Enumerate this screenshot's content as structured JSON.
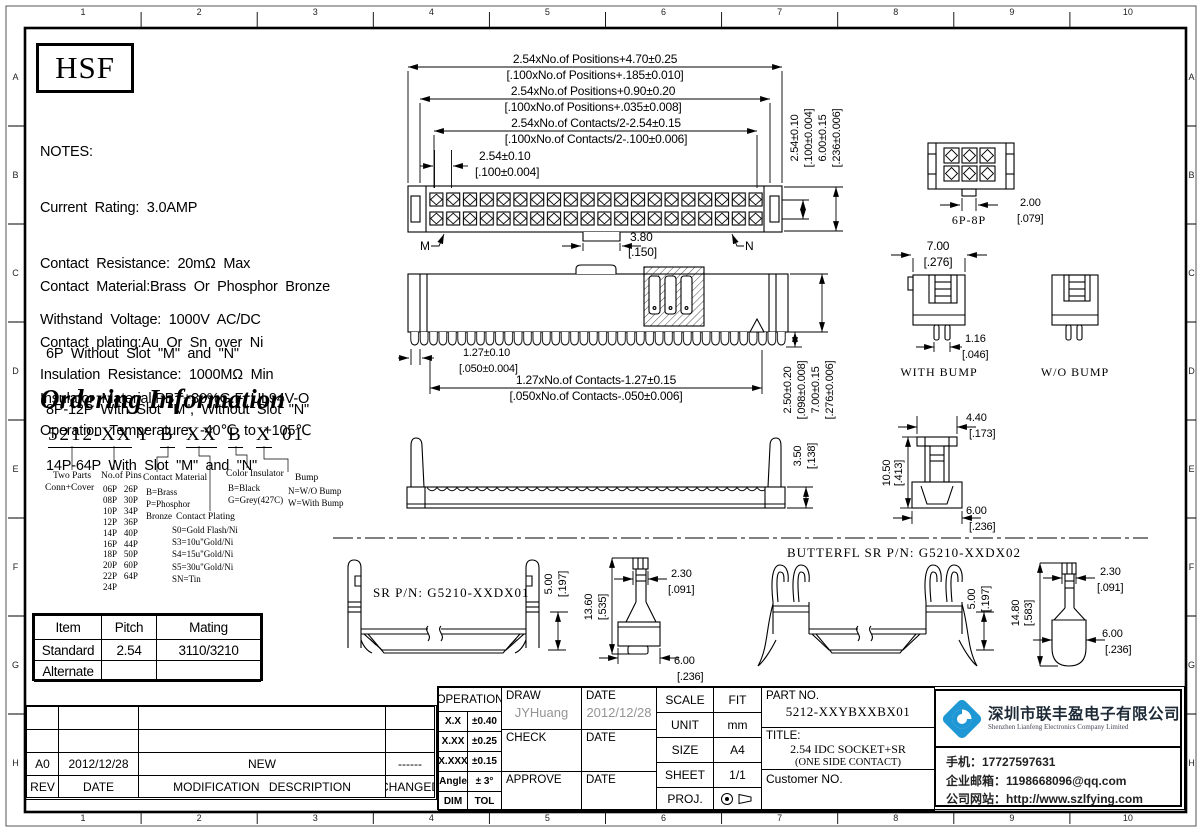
{
  "frame": {
    "columns": [
      "1",
      "2",
      "3",
      "4",
      "5",
      "6",
      "7",
      "8",
      "9",
      "10"
    ],
    "rows": [
      "A",
      "B",
      "C",
      "D",
      "E",
      "F",
      "G",
      "H"
    ]
  },
  "logo": {
    "text": "HSF"
  },
  "notes": {
    "title": "NOTES:",
    "lines": [
      "Current  Rating:  3.0AMP",
      "Contact  Resistance:  20mΩ  Max",
      "Withstand  Voltage:  1000V  AC/DC",
      "Insulation  Resistance:  1000MΩ  Min",
      "Operation  Temperature:  -40℃  to  +105℃"
    ],
    "material": [
      "Contact  Material:Brass  Or  Phosphor  Bronze",
      "Contact  plating:Au  Or  Sn  over  Ni",
      "Insulator  Material:PBT+30%G.F  UL94V-O"
    ],
    "slots": [
      "6P  Without  Slot  \"M\"  and  \"N\"",
      "8P-12P  With  Slot  \"M\",  Without  Slot  \"N\"",
      "14P-64P  With  Slot  \"M\"  and  \"N\""
    ]
  },
  "ordering": {
    "title": "Ordering Information",
    "code": [
      "5212-",
      "XX",
      "Y",
      "B",
      "XX",
      "B",
      "X",
      "01"
    ],
    "groups": {
      "two_parts": {
        "l1": "Two Parts",
        "l2": "Conn+Cover"
      },
      "pins": {
        "label": "No.of Pins",
        "items": [
          "06P 26P",
          "08P 30P",
          "10P 34P",
          "12P 36P",
          "14P 40P",
          "16P 44P",
          "18P 50P",
          "20P 60P",
          "22P 64P",
          "24P"
        ]
      },
      "contact_material": {
        "label": "Contact Material",
        "lines": [
          "B=Brass",
          "P=Phosphor",
          "Bronze"
        ]
      },
      "contact_plating": {
        "label": "Contact Plating",
        "lines": [
          "S0=Gold Flash/Ni",
          "S3=10u\"Gold/Ni",
          "S4=15u\"Gold/Ni",
          "S5=30u\"Gold/Ni",
          "SN=Tin"
        ]
      },
      "color_insulator": {
        "label": "Color Insulator",
        "lines": [
          "B=Black",
          "G=Grey(427C)"
        ]
      },
      "bump": {
        "label": "Bump",
        "lines": [
          "N=W/O Bump",
          "W=With Bump"
        ]
      }
    }
  },
  "mating_table": {
    "headers": [
      "Item",
      "Pitch",
      "Mating"
    ],
    "rows": [
      [
        "Standard",
        "2.54",
        "3110/3210"
      ],
      [
        "Alternate",
        "",
        ""
      ]
    ]
  },
  "rev_table": {
    "row": [
      "A0",
      "2012/12/28",
      "NEW",
      "------"
    ],
    "headers": [
      "REV",
      "DATE",
      "MODIFICATION  DESCRIPTION",
      "CHANGED"
    ]
  },
  "dims": {
    "top": [
      {
        "mm": "2.54xNo.of  Positions+4.70±0.25",
        "in": "[.100xNo.of  Positions+.185±0.010]"
      },
      {
        "mm": "2.54xNo.of  Positions+0.90±0.20",
        "in": "[.100xNo.of  Positions+.035±0.008]"
      },
      {
        "mm": "2.54xNo.of  Contacts/2-2.54±0.15",
        "in": "[.100xNo.of  Contacts/2-.100±0.006]"
      },
      {
        "mm": "2.54±0.10",
        "in": "[.100±0.004]"
      }
    ],
    "row_pitch": {
      "mm": "2.54±0.10",
      "in": "[.100±0.004]"
    },
    "height": {
      "mm": "6.00±0.15",
      "in": "[.236±0.006]"
    },
    "notch": {
      "mm": "3.80",
      "in": "[.150]"
    },
    "m": "M",
    "n": "N",
    "v68": {
      "label": "6P-8P",
      "mm": "2.00",
      "in": "[.079]"
    },
    "pitch127": {
      "mm": "1.27±0.10",
      "in": "[.050±0.004]"
    },
    "span127": {
      "mm": "1.27xNo.of  Contacts-1.27±0.15",
      "in": "[.050xNo.of  Contacts-.050±0.006]"
    },
    "d250": {
      "mm": "2.50±0.20",
      "in": "[.098±0.008]"
    },
    "d700t": {
      "mm": "7.00±0.15",
      "in": "[.276±0.006]"
    },
    "d700": {
      "mm": "7.00",
      "in": "[.276]"
    },
    "d116": {
      "mm": "1.16",
      "in": "[.046]"
    },
    "with_bump": "WITH BUMP",
    "wo_bump": "W/O BUMP",
    "d350": {
      "mm": "3.50",
      "in": "[.138]"
    },
    "d440": {
      "mm": "4.40",
      "in": "[.173]"
    },
    "d1050": {
      "mm": "10.50",
      "in": "[.413]"
    },
    "d600": {
      "mm": "6.00",
      "in": "[.236]"
    },
    "sr1": {
      "label": "SR P/N: G5210-XXDX01",
      "d500mm": "5.00",
      "d500in": "[.197]",
      "d1360mm": "13.60",
      "d1360in": "[.535]",
      "d230mm": "2.30",
      "d230in": "[.091]",
      "d600mm": "6.00",
      "d600in": "[.236]"
    },
    "sr2": {
      "label": "BUTTERFL SR P/N: G5210-XXDX02",
      "d500mm": "5.00",
      "d500in": "[.197]",
      "d1480mm": "14.80",
      "d1480in": "[.583]",
      "d230mm": "2.30",
      "d230in": "[.091]",
      "d600mm": "6.00",
      "d600in": "[.236]"
    }
  },
  "title_block": {
    "operation": {
      "header": "OPERATION",
      "rows": [
        [
          "X.X",
          "±0.40"
        ],
        [
          "X.XX",
          "±0.25"
        ],
        [
          "X.XXX",
          "±0.15"
        ],
        [
          "Angle",
          "± 3°"
        ],
        [
          "DIM",
          "TOL"
        ]
      ]
    },
    "sign": {
      "draw": "DRAW",
      "date": "DATE",
      "check": "CHECK",
      "approve": "APPROVE",
      "draw_name": "JYHuang",
      "draw_date": "2012/12/28"
    },
    "info": {
      "scale_l": "SCALE",
      "scale_v": "FIT",
      "unit_l": "UNIT",
      "unit_v": "mm",
      "size_l": "SIZE",
      "size_v": "A4",
      "sheet_l": "SHEET",
      "sheet_v": "1/1",
      "proj_l": "PROJ."
    },
    "part": {
      "label": "PART NO.",
      "no": "5212-XXYBXXBX01",
      "title_l": "TITLE:",
      "t1": "2.54 IDC SOCKET+SR",
      "t2": "(ONE SIDE CONTACT)",
      "customer": "Customer  NO."
    }
  },
  "company": {
    "cn": "深圳市联丰盈电子有限公司",
    "en": "Shenzhen Lianfeng Electronics Company Limited",
    "phone": "手机：17727597631",
    "email": "企业邮箱：1198668096@qq.com",
    "web": "公司网站：http://www.szlfying.com",
    "accent_blue": "#1f97d4"
  }
}
